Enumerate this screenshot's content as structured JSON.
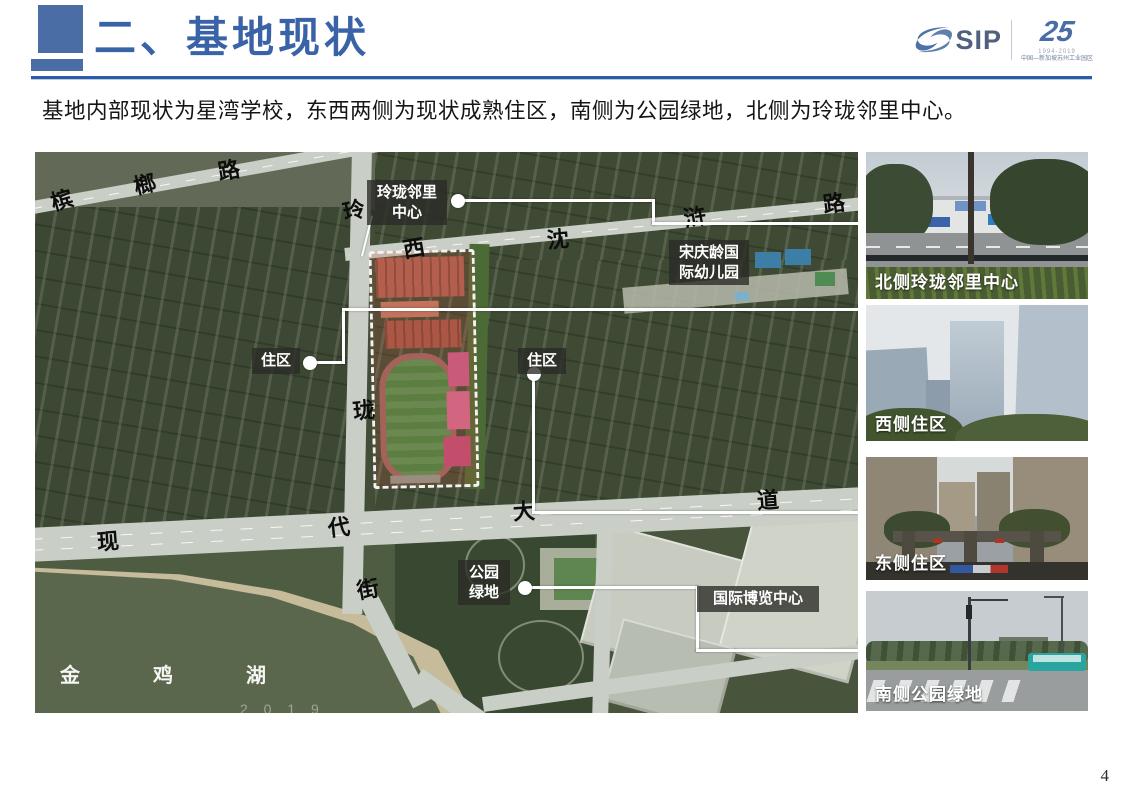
{
  "slide": {
    "page_number": "4"
  },
  "header": {
    "title": "二、基地现状",
    "accent_color": "#3a63a7",
    "logo": {
      "sip_text": "SIP",
      "anniversary": "25",
      "years": "1994-2019",
      "org_line": "中国—新加坡苏州工业园区"
    }
  },
  "intro_text": "基地内部现状为星湾学校，东西两侧为现状成熟住区，南侧为公园绿地，北侧为玲珑邻里中心。",
  "map": {
    "road_name_chars": [
      "槟",
      "榔",
      "路",
      "玲",
      "西",
      "沈",
      "浒",
      "路",
      "珑",
      "现",
      "代",
      "大",
      "道",
      "街"
    ],
    "lake_name_chars": [
      "金",
      "鸡",
      "湖"
    ],
    "watermark": "2 0 1 9",
    "site_name_note": "星湾学校用地（红线虚框）",
    "callout_labels": [
      {
        "id": "nlc",
        "lines": [
          "玲珑邻里",
          "中心"
        ]
      },
      {
        "id": "kindergarten",
        "lines": [
          "宋庆龄国",
          "际幼儿园"
        ]
      },
      {
        "id": "res-west",
        "lines": [
          "住区"
        ]
      },
      {
        "id": "res-east",
        "lines": [
          "住区"
        ]
      },
      {
        "id": "park",
        "lines": [
          "公园",
          "绿地"
        ]
      },
      {
        "id": "expo",
        "lines": [
          "国际博览中心"
        ]
      }
    ]
  },
  "photos": [
    {
      "caption": "北侧玲珑邻里中心"
    },
    {
      "caption": "西侧住区"
    },
    {
      "caption": "东侧住区"
    },
    {
      "caption": "南侧公园绿地"
    }
  ]
}
